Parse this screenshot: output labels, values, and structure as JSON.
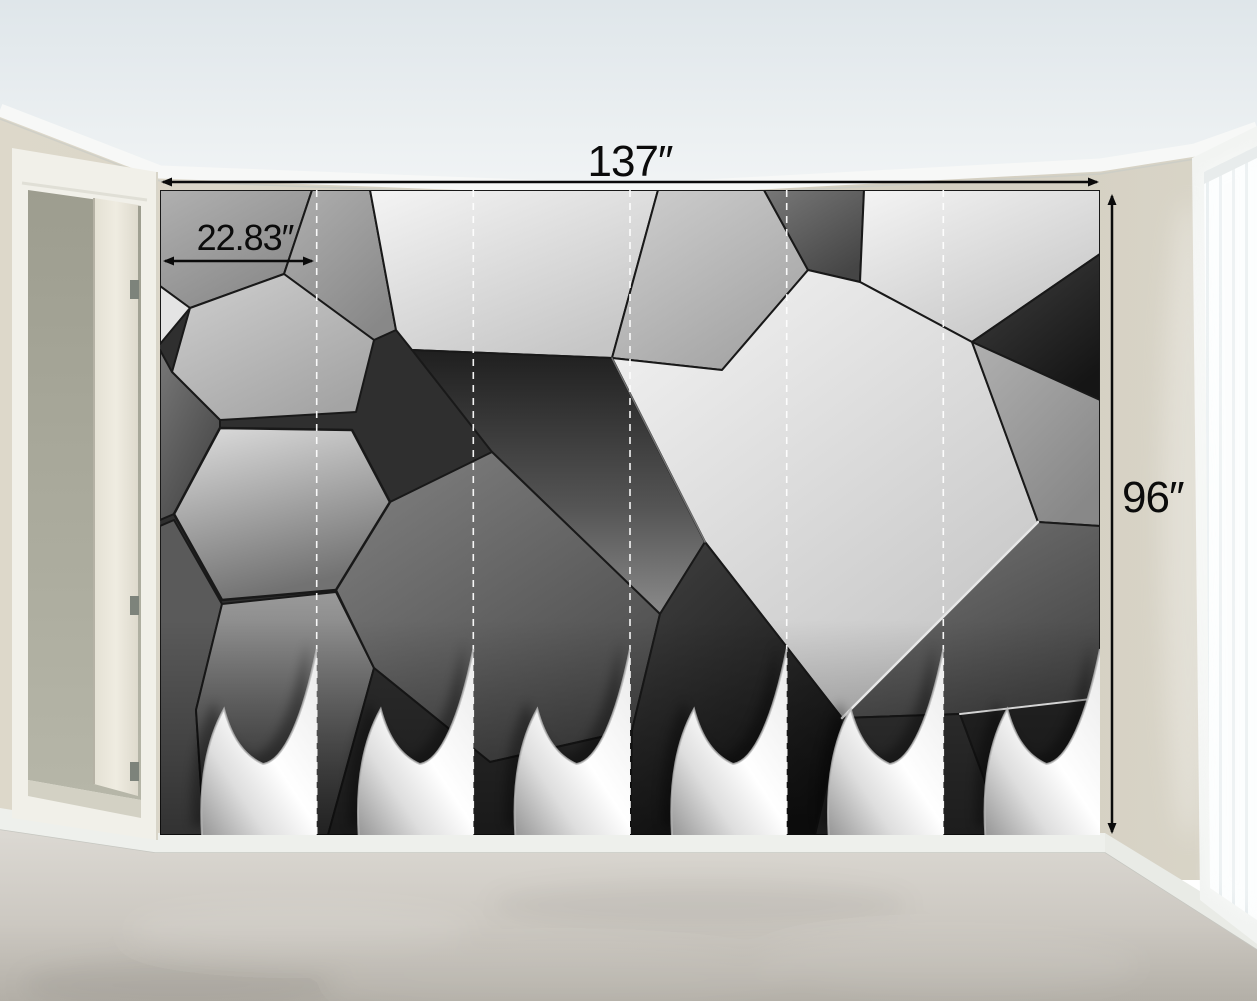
{
  "annotations": {
    "mural_width_label": "137″",
    "mural_height_label": "96″",
    "panel_width_label": "22.83″"
  },
  "mural": {
    "panel_count": 6,
    "pattern": "3d-geometric-polygon-grayscale",
    "separator_style": "white-dashed-vertical"
  },
  "colors": {
    "wall": "#d7d2c4",
    "ceiling": "#e3e9ec",
    "carpet": "#c9c5bd",
    "baseboard": "#eef0ec",
    "annotation_ink": "#0b0b0b",
    "mural_light_facet": "#f0f0f0",
    "mural_dark_facet": "#1a1a1a",
    "curl_backing": "#ffffff"
  }
}
